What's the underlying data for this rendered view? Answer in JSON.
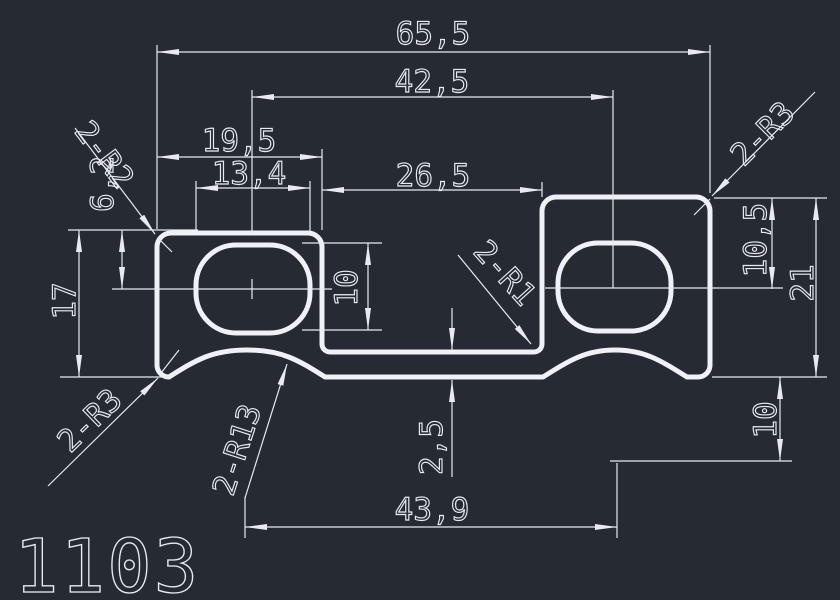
{
  "drawing": {
    "number": "1103",
    "background_color": "#252a33",
    "line_color": "#eef1f5"
  },
  "dims": {
    "total_width": "65,5",
    "hole_center_span": "42,5",
    "left_tab_width": "19,5",
    "hole_width": "13,4",
    "recess_width": "26,5",
    "hole_height": "10",
    "top_to_hole_center_left": "6,2",
    "left_tab_height": "17",
    "top_to_hole_center_right": "10,5",
    "right_tab_height": "21",
    "step_height": "10",
    "web_thickness": "2,5",
    "bottom_span": "43,9"
  },
  "radius_labels": {
    "top_left": "2-R2",
    "top_right": "2-R3",
    "bottom_left": "2-R3",
    "bottom_scallop": "2-R13",
    "recess_corner": "2-R1"
  }
}
